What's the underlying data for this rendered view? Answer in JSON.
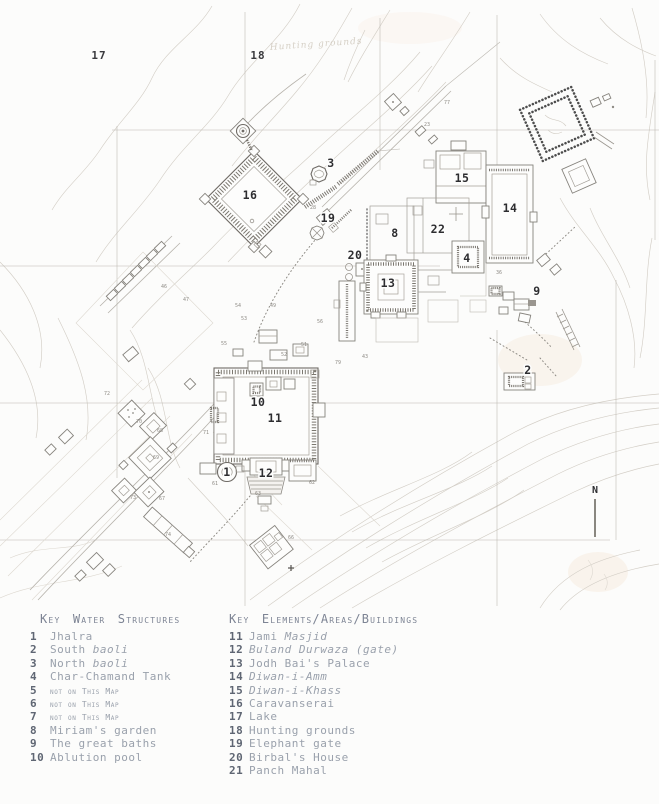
{
  "map": {
    "region_labels": [
      {
        "t": "17",
        "x": 99,
        "y": 59
      },
      {
        "t": "18",
        "x": 258,
        "y": 59
      }
    ],
    "labels": [
      {
        "t": "16",
        "x": 250,
        "y": 199
      },
      {
        "t": "3",
        "x": 331,
        "y": 167
      },
      {
        "t": "19",
        "x": 328,
        "y": 222
      },
      {
        "t": "15",
        "x": 462,
        "y": 182
      },
      {
        "t": "14",
        "x": 510,
        "y": 212
      },
      {
        "t": "22",
        "x": 438,
        "y": 233
      },
      {
        "t": "8",
        "x": 395,
        "y": 237
      },
      {
        "t": "20",
        "x": 355,
        "y": 259
      },
      {
        "t": "4",
        "x": 467,
        "y": 262
      },
      {
        "t": "13",
        "x": 388,
        "y": 287
      },
      {
        "t": "10",
        "x": 258,
        "y": 406
      },
      {
        "t": "11",
        "x": 275,
        "y": 422
      },
      {
        "t": "12",
        "x": 266,
        "y": 477
      },
      {
        "t": "1",
        "x": 227,
        "y": 476
      },
      {
        "t": "2",
        "x": 528,
        "y": 374
      },
      {
        "t": "9",
        "x": 537,
        "y": 295
      }
    ],
    "minor_labels": [
      {
        "t": "46",
        "x": 164,
        "y": 288
      },
      {
        "t": "47",
        "x": 186,
        "y": 301
      },
      {
        "t": "54",
        "x": 238,
        "y": 307
      },
      {
        "t": "49",
        "x": 273,
        "y": 307
      },
      {
        "t": "53",
        "x": 244,
        "y": 320
      },
      {
        "t": "56",
        "x": 320,
        "y": 323
      },
      {
        "t": "51",
        "x": 304,
        "y": 346
      },
      {
        "t": "52",
        "x": 284,
        "y": 356
      },
      {
        "t": "55",
        "x": 224,
        "y": 345
      },
      {
        "t": "79",
        "x": 338,
        "y": 364
      },
      {
        "t": "43",
        "x": 365,
        "y": 358
      },
      {
        "t": "36",
        "x": 499,
        "y": 274
      },
      {
        "t": "28",
        "x": 313,
        "y": 209
      },
      {
        "t": "23",
        "x": 427,
        "y": 126
      },
      {
        "t": "77",
        "x": 447,
        "y": 104
      },
      {
        "t": "72",
        "x": 107,
        "y": 395
      },
      {
        "t": "70",
        "x": 139,
        "y": 423
      },
      {
        "t": "68",
        "x": 160,
        "y": 432
      },
      {
        "t": "71",
        "x": 206,
        "y": 434
      },
      {
        "t": "69",
        "x": 156,
        "y": 459
      },
      {
        "t": "73",
        "x": 133,
        "y": 499
      },
      {
        "t": "67",
        "x": 162,
        "y": 500
      },
      {
        "t": "74",
        "x": 168,
        "y": 536
      },
      {
        "t": "61",
        "x": 215,
        "y": 485
      },
      {
        "t": "63",
        "x": 258,
        "y": 495
      },
      {
        "t": "62",
        "x": 312,
        "y": 484
      },
      {
        "t": "66",
        "x": 291,
        "y": 539
      }
    ],
    "handwritten_note": "Hunting grounds",
    "north_label": "N"
  },
  "legend": {
    "water": {
      "title": "Key Water Structures",
      "items": [
        {
          "num": "1",
          "parts": [
            {
              "t": "Jhalra"
            }
          ]
        },
        {
          "num": "2",
          "parts": [
            {
              "t": "South "
            },
            {
              "t": "baoli",
              "i": true
            }
          ]
        },
        {
          "num": "3",
          "parts": [
            {
              "t": "North "
            },
            {
              "t": "baoli",
              "i": true
            }
          ]
        },
        {
          "num": "4",
          "parts": [
            {
              "t": "Char-Chamand Tank"
            }
          ]
        },
        {
          "num": "5",
          "small": true,
          "parts": [
            {
              "t": "not on This Map"
            }
          ]
        },
        {
          "num": "6",
          "small": true,
          "parts": [
            {
              "t": "not on This Map"
            }
          ]
        },
        {
          "num": "7",
          "small": true,
          "parts": [
            {
              "t": "not on This Map"
            }
          ]
        },
        {
          "num": "8",
          "parts": [
            {
              "t": "Miriam's garden"
            }
          ]
        },
        {
          "num": "9",
          "parts": [
            {
              "t": "The great baths"
            }
          ]
        },
        {
          "num": "10",
          "parts": [
            {
              "t": "Ablution pool"
            }
          ]
        }
      ]
    },
    "elements": {
      "title": "Key Elements/Areas/Buildings",
      "items": [
        {
          "num": "11",
          "parts": [
            {
              "t": "Jami "
            },
            {
              "t": "Masjid",
              "i": true
            }
          ]
        },
        {
          "num": "12",
          "parts": [
            {
              "t": "Buland Durwaza (gate)",
              "i": true
            }
          ]
        },
        {
          "num": "13",
          "parts": [
            {
              "t": "Jodh Bai's Palace"
            }
          ]
        },
        {
          "num": "14",
          "parts": [
            {
              "t": "Diwan-i-Amm",
              "i": true
            }
          ]
        },
        {
          "num": "15",
          "parts": [
            {
              "t": "Diwan-i-Khass",
              "i": true
            }
          ]
        },
        {
          "num": "16",
          "parts": [
            {
              "t": "Caravanserai"
            }
          ]
        },
        {
          "num": "17",
          "parts": [
            {
              "t": "Lake"
            }
          ]
        },
        {
          "num": "18",
          "parts": [
            {
              "t": "Hunting grounds"
            }
          ]
        },
        {
          "num": "19",
          "parts": [
            {
              "t": "Elephant gate"
            }
          ]
        },
        {
          "num": "20",
          "parts": [
            {
              "t": "Birbal's House"
            }
          ]
        },
        {
          "num": "21",
          "parts": [
            {
              "t": "Panch Mahal"
            }
          ]
        }
      ]
    }
  }
}
